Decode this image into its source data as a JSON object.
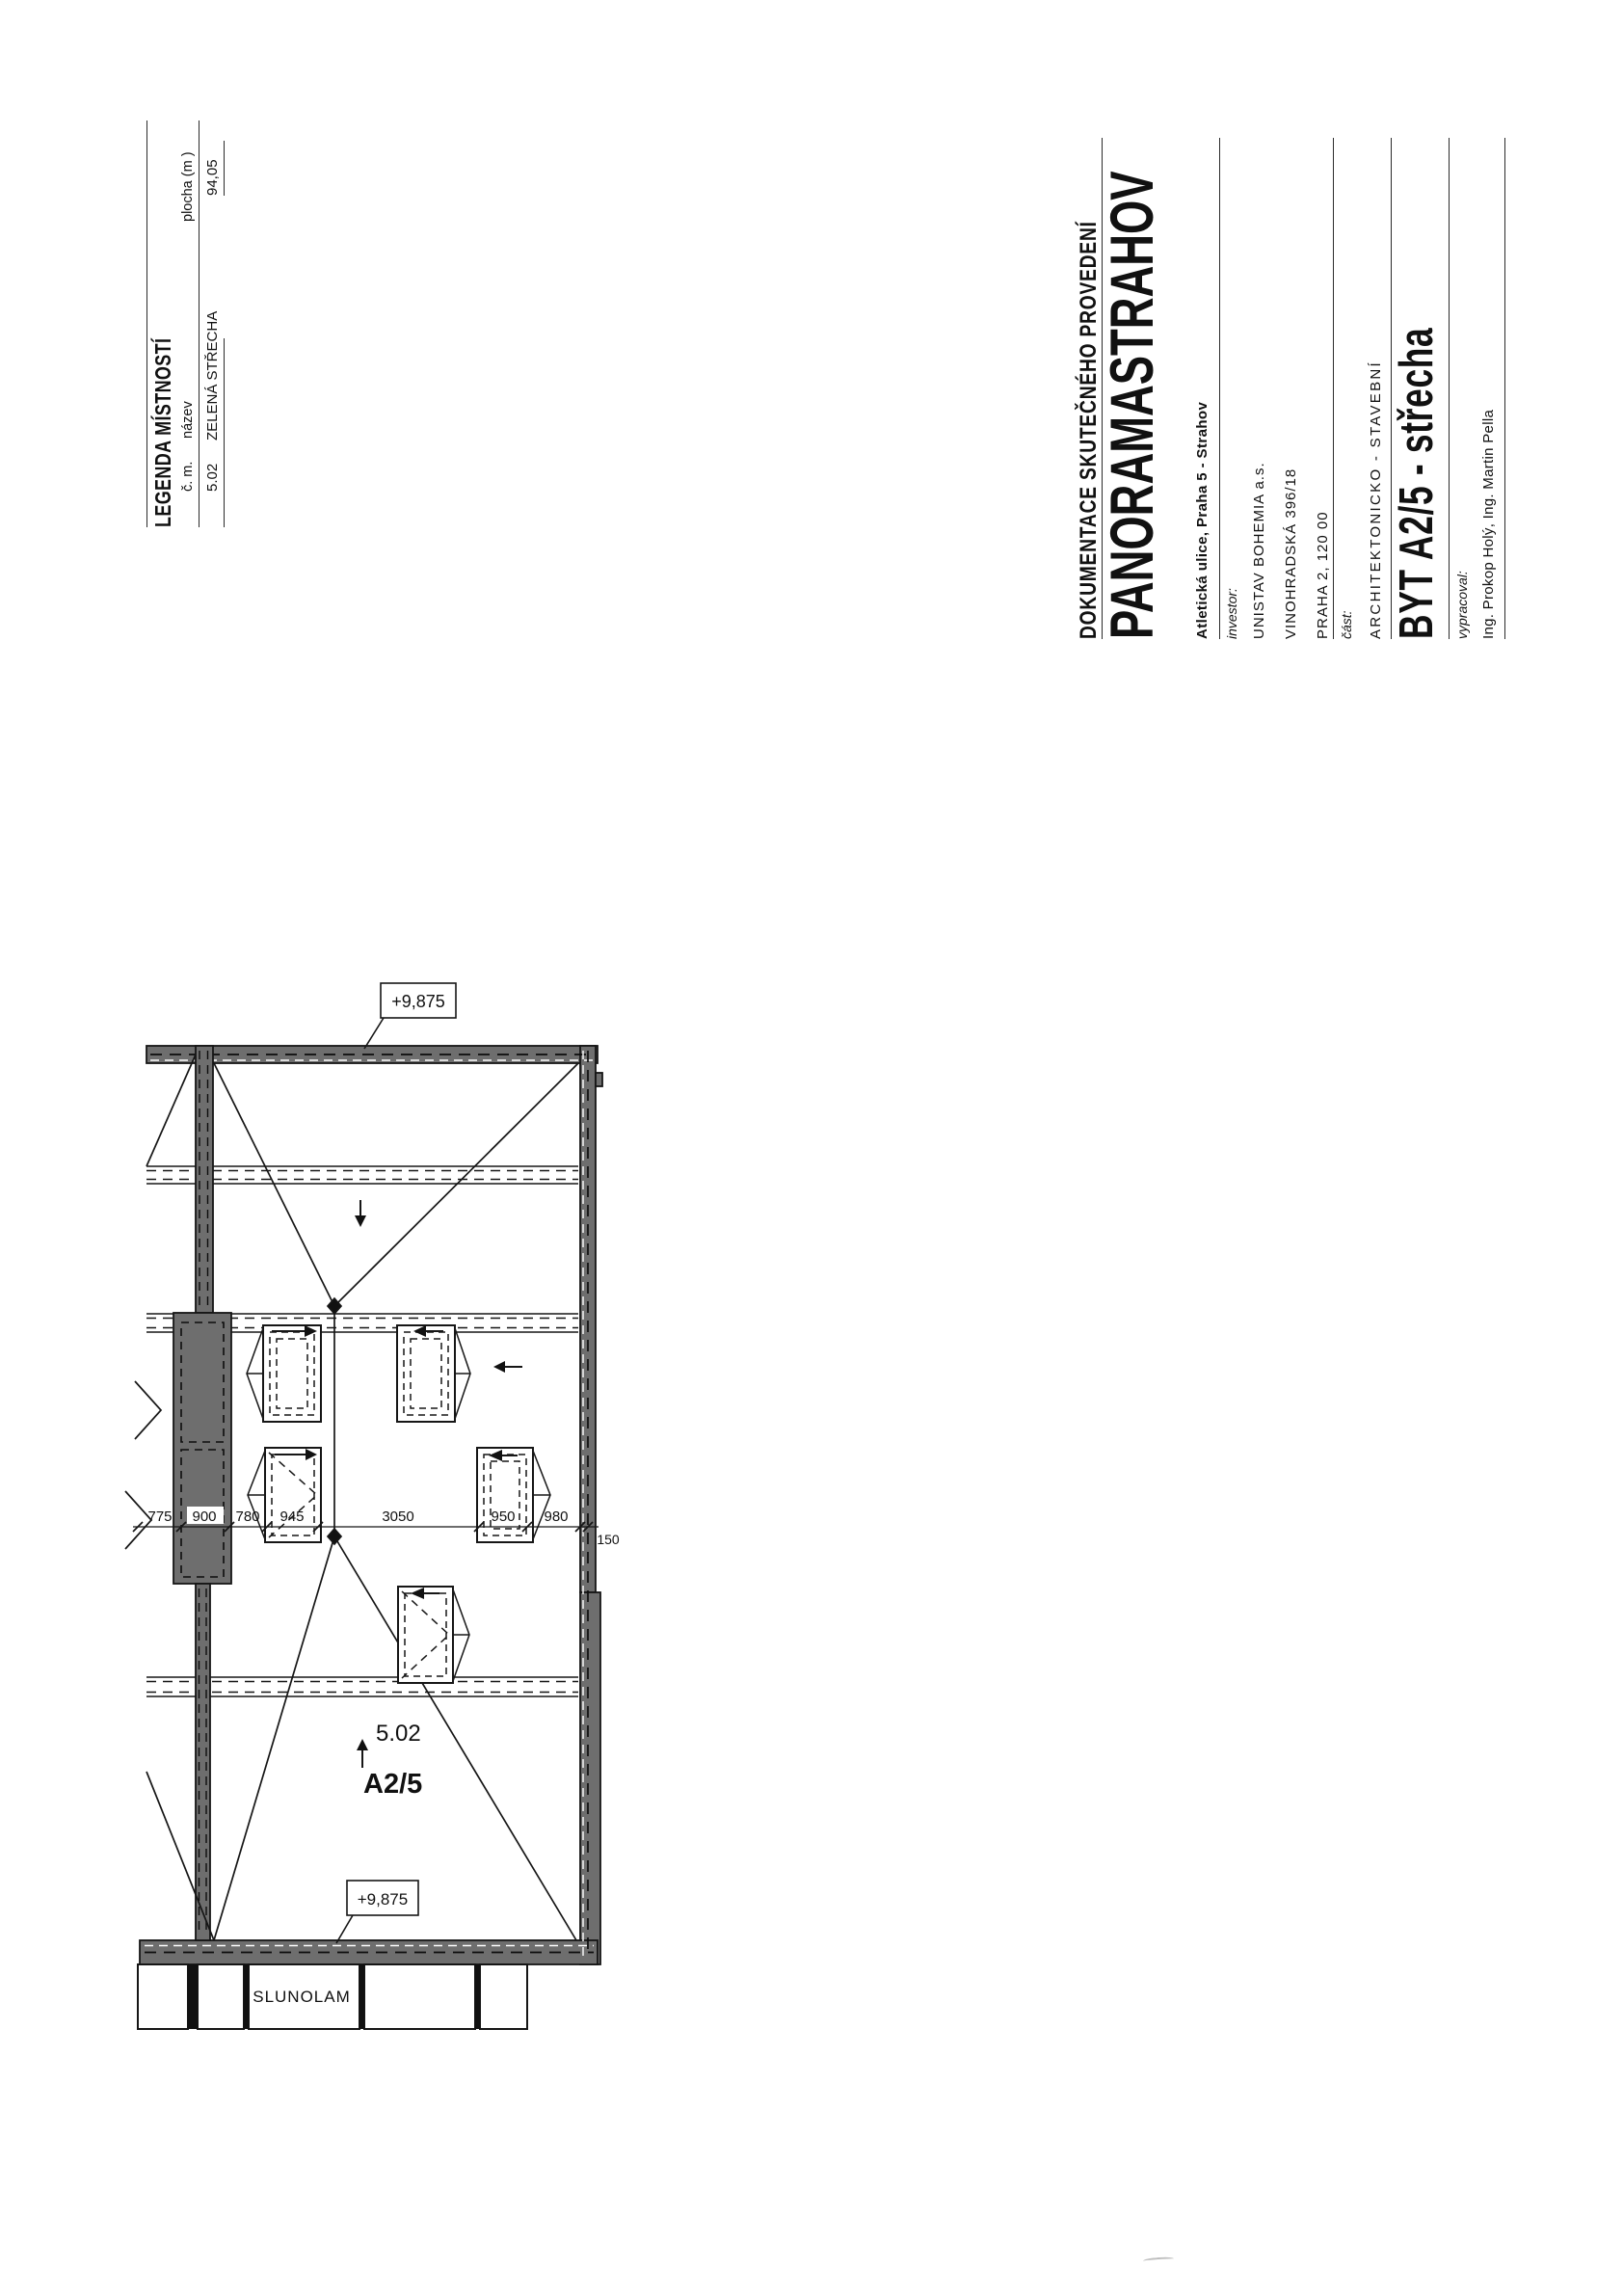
{
  "legend": {
    "title": "LEGENDA MÍSTNOSTÍ",
    "col_number": "č. m.",
    "col_name": "název",
    "col_area": "plocha (m )",
    "row_number": "5.02",
    "row_name": "ZELENÁ STŘECHA",
    "row_area": "94,05"
  },
  "title_block": {
    "doc_type": "DOKUMENTACE SKUTEČNÉHO PROVEDENÍ",
    "project": "PANORAMASTRAHOV",
    "address": "Atletická ulice, Praha 5 - Strahov",
    "investor_label": "investor:",
    "investor_name": "UNISTAV BOHEMIA a.s.",
    "investor_street": "VINOHRADSKÁ 396/18",
    "investor_city": "PRAHA 2, 120 00",
    "part_label": "část:",
    "part_value": "ARCHITEKTONICKO - STAVEBNÍ",
    "drawing_title": "BYT A2/5 - střecha",
    "author_label": "vypracoval:",
    "authors": "Ing. Prokop Holý, Ing. Martin Pella"
  },
  "plan": {
    "room_number": "5.02",
    "unit_label": "A2/5",
    "level_top": "+9,875",
    "level_bottom": "+9,875",
    "louver_label": "SLUNOLAM",
    "wall_thickness": "150",
    "dims": [
      "775",
      "900",
      "780",
      "945",
      "3050",
      "950",
      "980"
    ]
  }
}
